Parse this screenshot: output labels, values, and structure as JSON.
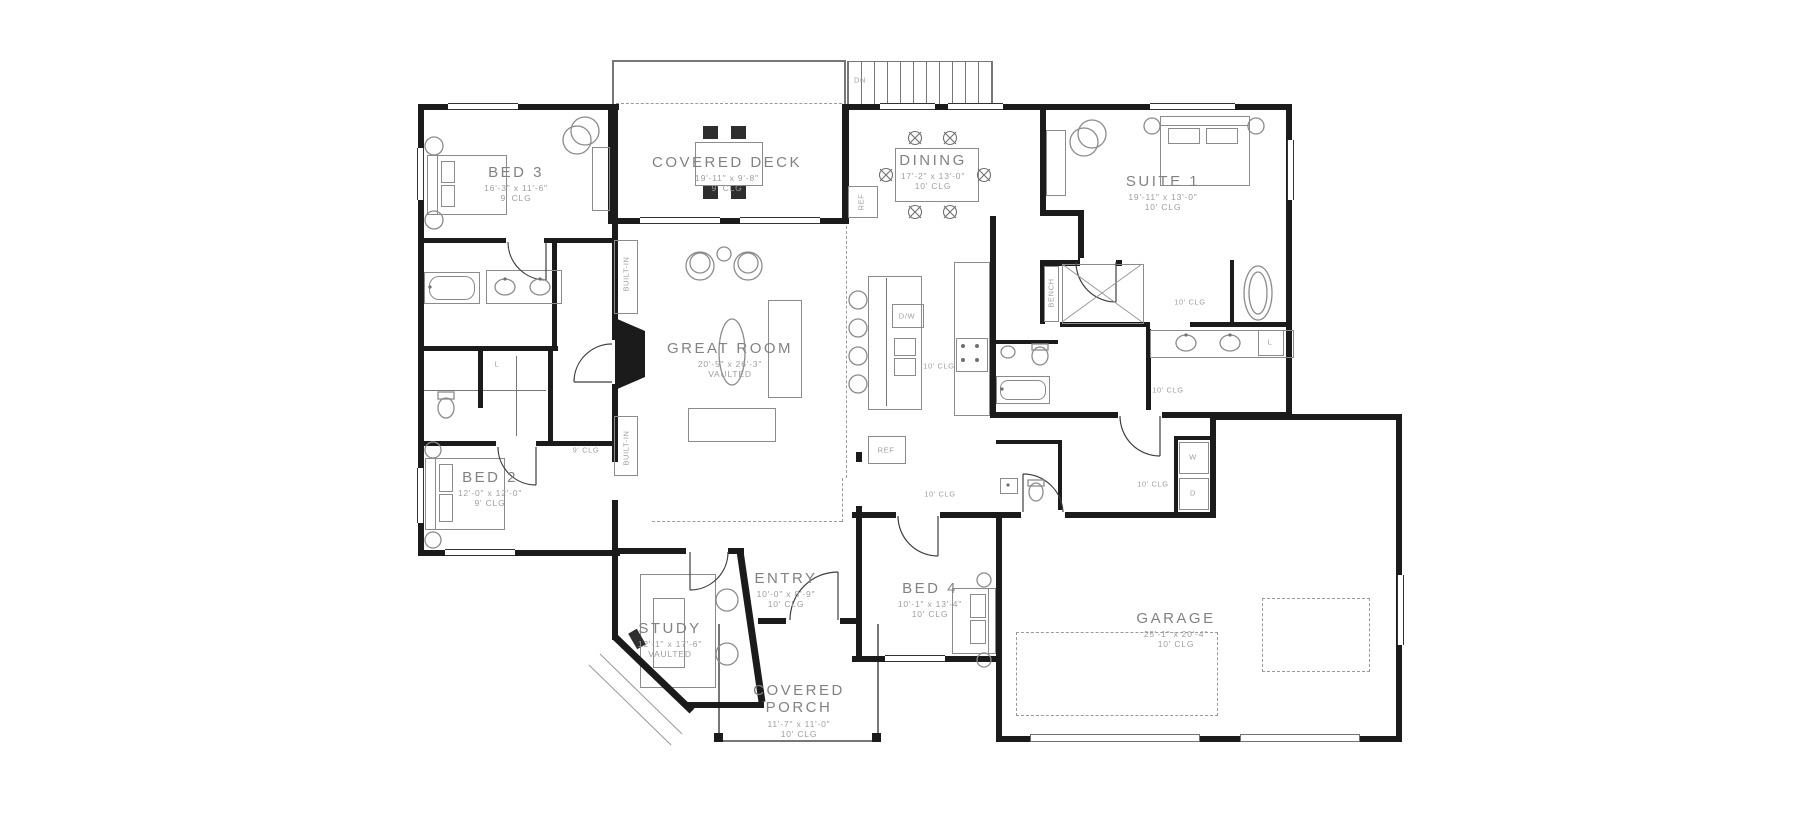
{
  "plan": {
    "rooms": [
      {
        "id": "bed3",
        "name": "BED 3",
        "dims": "16'-3\" x 11'-6\"",
        "clg": "9' CLG"
      },
      {
        "id": "covered_deck",
        "name": "COVERED DECK",
        "dims": "19'-11\" x 9'-8\"",
        "clg": "9' CLG"
      },
      {
        "id": "dining",
        "name": "DINING",
        "dims": "17'-2\" x 13'-0\"",
        "clg": "10' CLG"
      },
      {
        "id": "suite1",
        "name": "SUITE 1",
        "dims": "19'-11\" x 13'-0\"",
        "clg": "10' CLG"
      },
      {
        "id": "great_room",
        "name": "GREAT ROOM",
        "dims": "20'-5\" x 26'-3\"",
        "clg": "VAULTED"
      },
      {
        "id": "bed2",
        "name": "BED 2",
        "dims": "12'-0\" x 12'-0\"",
        "clg": "9' CLG"
      },
      {
        "id": "study",
        "name": "STUDY",
        "dims": "12'-1\" x 17'-6\"",
        "clg": "VAULTED"
      },
      {
        "id": "entry",
        "name": "ENTRY",
        "dims": "10'-0\" x 8'-9\"",
        "clg": "10' CLG"
      },
      {
        "id": "covered_porch",
        "name": "COVERED PORCH",
        "dims": "11'-7\" x 11'-0\"",
        "clg": "10' CLG"
      },
      {
        "id": "bed4",
        "name": "BED 4",
        "dims": "10'-1\" x 13'-4\"",
        "clg": "10' CLG"
      },
      {
        "id": "garage",
        "name": "GARAGE",
        "dims": "25'-1\" x 20'-4\"",
        "clg": "10' CLG"
      }
    ],
    "annotations": {
      "stairs": "DN",
      "built_in": "BUILT-IN",
      "fridge": "REF",
      "dishwasher": "D/W",
      "bench": "BENCH",
      "washer": "W",
      "dryer": "D",
      "linen": "L",
      "clg9": "9' CLG",
      "clg10": "10' CLG"
    },
    "colors": {
      "wall": "#1b1b1b",
      "fixture": "#8b8b8b",
      "text": "#828282"
    }
  }
}
